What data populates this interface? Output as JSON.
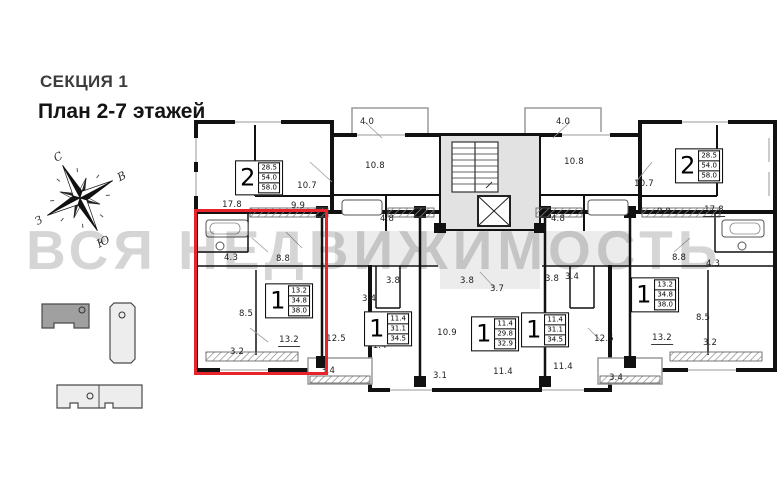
{
  "header": {
    "section": "СЕКЦИЯ 1",
    "plan": "План 2-7 этажей"
  },
  "watermark": "ВСЯ НЕДВИЖИМОСТЬ",
  "compass": {
    "north": "С",
    "east": "В",
    "south": "Ю",
    "west": "З"
  },
  "colors": {
    "highlight": "#e8232b",
    "wall": "#111111",
    "corridor": "#ececec",
    "stair_core": "#e2e2e2",
    "watermark_gray": "#b3b3b3",
    "sitemap_selected": "#a0a0a0",
    "sitemap_building": "#ededed"
  },
  "sitemap": {
    "buildings": [
      {
        "name": "selected-section-building",
        "selected": true
      },
      {
        "name": "building-vertical",
        "selected": false
      },
      {
        "name": "building-bottom",
        "selected": false
      }
    ]
  },
  "plan": {
    "apartments": [
      {
        "type": "2",
        "areas": [
          "28.5",
          "54.0",
          "58.0"
        ],
        "x": 259,
        "y": 178
      },
      {
        "type": "1",
        "areas": [
          "13.2",
          "34.8",
          "38.0"
        ],
        "x": 289,
        "y": 301,
        "highlighted": true
      },
      {
        "type": "1",
        "areas": [
          "11.4",
          "31.1",
          "34.5"
        ],
        "x": 388,
        "y": 329
      },
      {
        "type": "1",
        "areas": [
          "11.4",
          "29.8",
          "32.9"
        ],
        "x": 495,
        "y": 334
      },
      {
        "type": "1",
        "areas": [
          "11.4",
          "31.1",
          "34.5"
        ],
        "x": 545,
        "y": 330
      },
      {
        "type": "1",
        "areas": [
          "13.2",
          "34.8",
          "38.0"
        ],
        "x": 655,
        "y": 295
      },
      {
        "type": "2",
        "areas": [
          "28.5",
          "54.0",
          "58.0"
        ],
        "x": 699,
        "y": 166
      }
    ],
    "rooms": [
      {
        "area": "4.0",
        "x": 367,
        "y": 122
      },
      {
        "area": "10.8",
        "x": 375,
        "y": 166
      },
      {
        "area": "4.8",
        "x": 387,
        "y": 219
      },
      {
        "area": "10.7",
        "x": 307,
        "y": 186
      },
      {
        "area": "17.8",
        "x": 232,
        "y": 206,
        "u": true
      },
      {
        "area": "9.9",
        "x": 298,
        "y": 206
      },
      {
        "area": "4.0",
        "x": 563,
        "y": 122
      },
      {
        "area": "10.8",
        "x": 574,
        "y": 162
      },
      {
        "area": "4.8",
        "x": 558,
        "y": 219
      },
      {
        "area": "10.7",
        "x": 644,
        "y": 184
      },
      {
        "area": "9.9",
        "x": 664,
        "y": 212
      },
      {
        "area": "17.8",
        "x": 714,
        "y": 211,
        "u": true
      },
      {
        "area": "4.3",
        "x": 231,
        "y": 258
      },
      {
        "area": "8.8",
        "x": 283,
        "y": 259
      },
      {
        "area": "8.5",
        "x": 246,
        "y": 314
      },
      {
        "area": "13.2",
        "x": 289,
        "y": 341,
        "u": true
      },
      {
        "area": "3.2",
        "x": 237,
        "y": 352
      },
      {
        "area": "3.4",
        "x": 369,
        "y": 299
      },
      {
        "area": "3.8",
        "x": 393,
        "y": 281
      },
      {
        "area": "12.5",
        "x": 336,
        "y": 339
      },
      {
        "area": "11.4",
        "x": 377,
        "y": 346
      },
      {
        "area": "3.4",
        "x": 328,
        "y": 371
      },
      {
        "area": "3.8",
        "x": 467,
        "y": 281
      },
      {
        "area": "3.7",
        "x": 497,
        "y": 289
      },
      {
        "area": "10.9",
        "x": 447,
        "y": 333
      },
      {
        "area": "3.1",
        "x": 440,
        "y": 376
      },
      {
        "area": "11.4",
        "x": 503,
        "y": 372
      },
      {
        "area": "3.8",
        "x": 552,
        "y": 279
      },
      {
        "area": "3.4",
        "x": 572,
        "y": 277
      },
      {
        "area": "12.5",
        "x": 604,
        "y": 339
      },
      {
        "area": "11.4",
        "x": 563,
        "y": 367
      },
      {
        "area": "3.4",
        "x": 616,
        "y": 378
      },
      {
        "area": "8.8",
        "x": 679,
        "y": 258
      },
      {
        "area": "4.3",
        "x": 713,
        "y": 264
      },
      {
        "area": "8.5",
        "x": 703,
        "y": 318
      },
      {
        "area": "13.2",
        "x": 662,
        "y": 339,
        "u": true
      },
      {
        "area": "3.2",
        "x": 710,
        "y": 343
      }
    ]
  }
}
